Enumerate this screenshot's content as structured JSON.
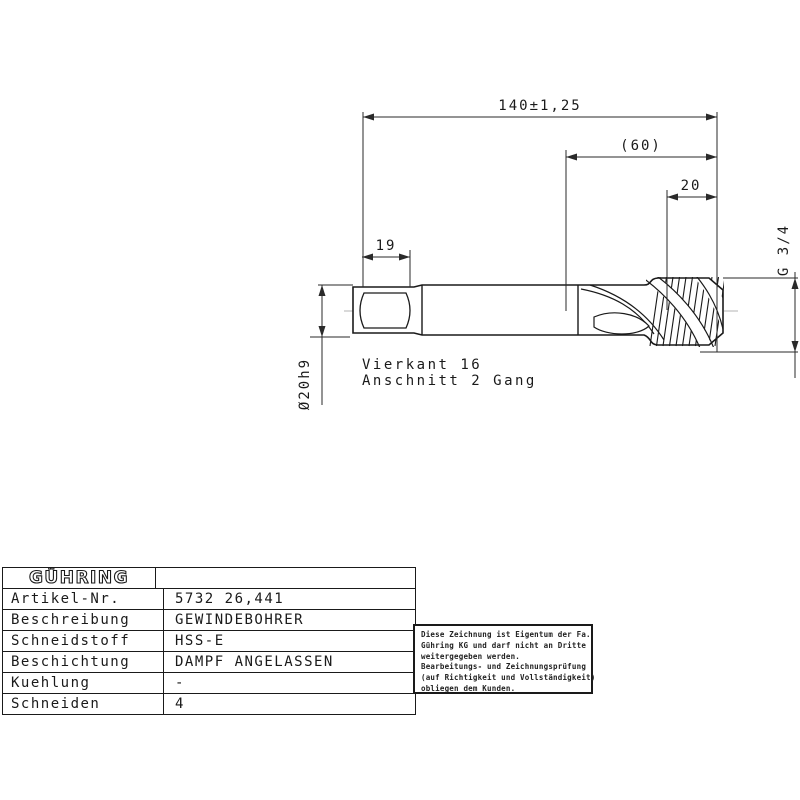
{
  "drawing": {
    "dimensions": {
      "overall_length": "140±1,25",
      "flute_length": "(60)",
      "thread_length": "20",
      "square_length": "19",
      "shank_diameter": "Ø20h9",
      "thread_size": "G 3/4"
    },
    "annotations": {
      "square": "Vierkant 16",
      "lead": "Anschnitt 2 Gang"
    }
  },
  "spec_table": {
    "brand": "GÜHRING",
    "rows": [
      {
        "label": "Artikel-Nr.",
        "value": "5732 26,441"
      },
      {
        "label": "Beschreibung",
        "value": "GEWINDEBOHRER"
      },
      {
        "label": "Schneidstoff",
        "value": "HSS-E"
      },
      {
        "label": "Beschichtung",
        "value": "DAMPF ANGELASSEN"
      },
      {
        "label": "Kuehlung",
        "value": "-"
      },
      {
        "label": "Schneiden",
        "value": "4"
      }
    ]
  },
  "disclaimer": {
    "lines": [
      "Diese Zeichnung ist Eigentum der Fa.",
      "Gühring KG und darf nicht an Dritte",
      "weitergegeben werden.",
      "Bearbeitungs- und Zeichnungsprüfung",
      "(auf Richtigkeit und Vollständigkeit)",
      "obliegen dem Kunden."
    ]
  },
  "colors": {
    "line": "#1a1a1a",
    "background": "#ffffff"
  }
}
